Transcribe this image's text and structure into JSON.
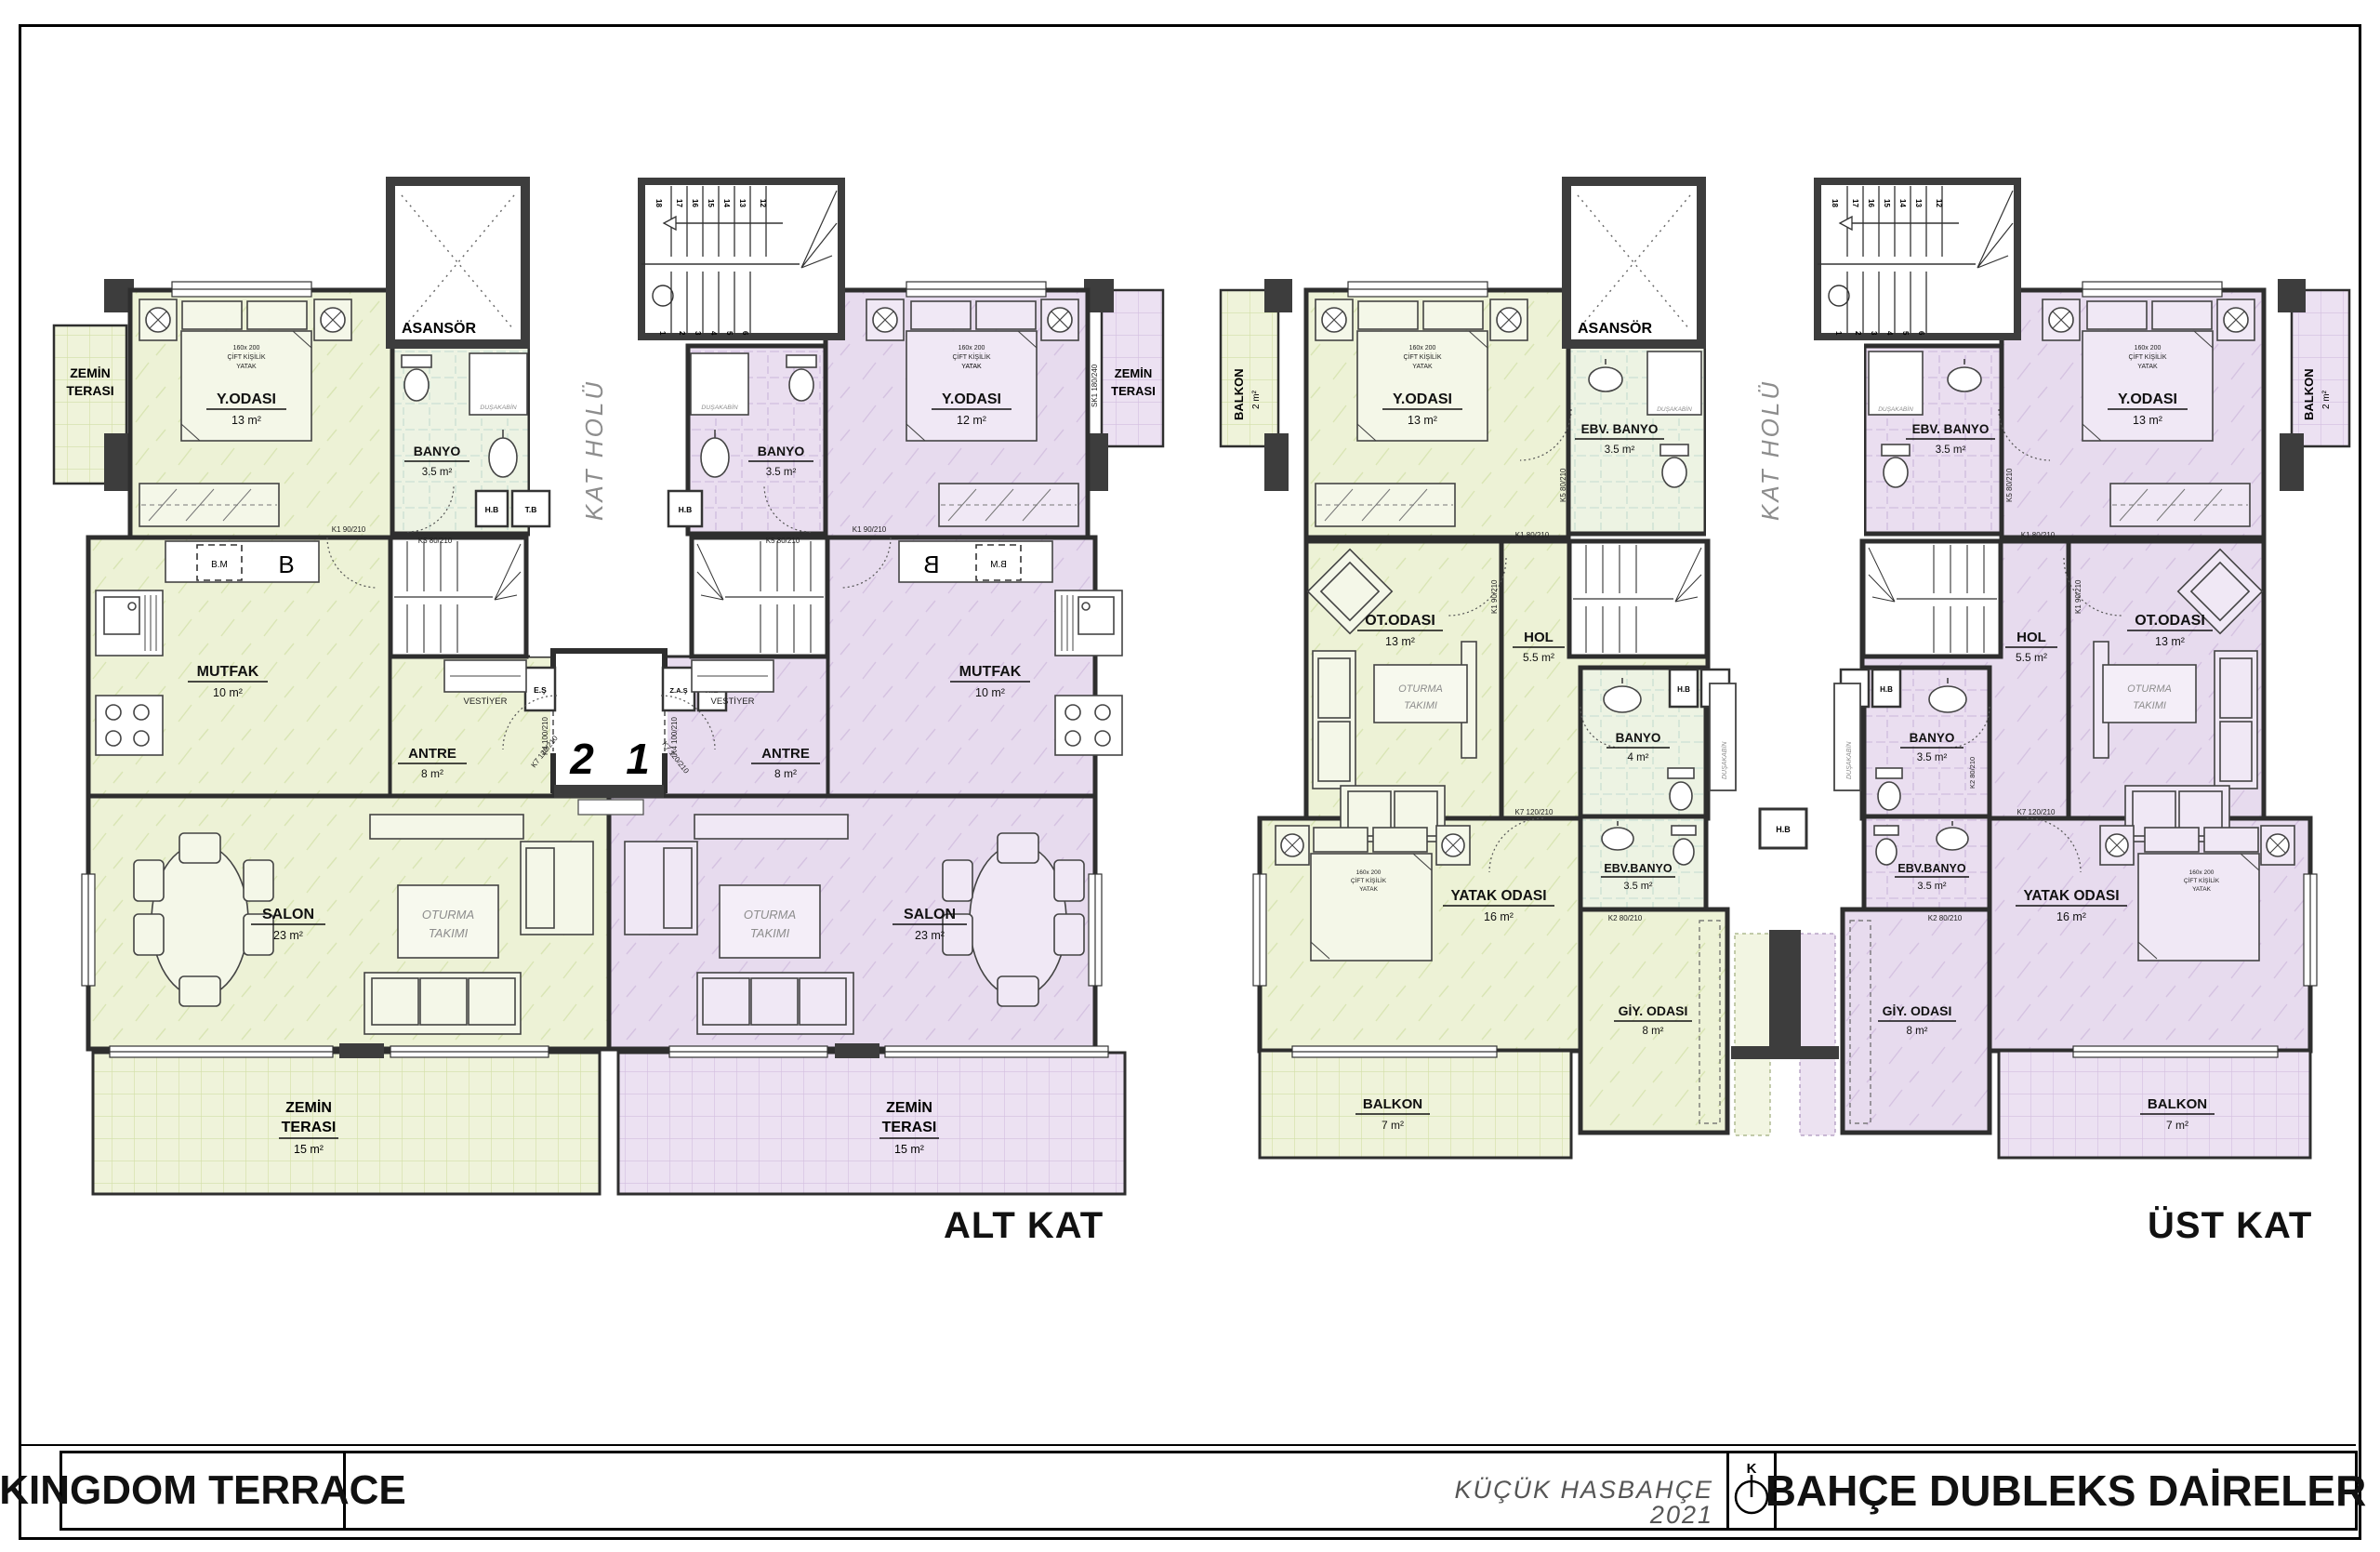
{
  "title_block": {
    "project": "KINGDOM TERRACE",
    "note1": "KÜÇÜK HASBAHÇE",
    "note2": "2021",
    "compass": "K",
    "sheet": "BAHÇE DUBLEKS DAİRELER"
  },
  "labels": {
    "alt_kat": "ALT KAT",
    "ust_kat": "ÜST KAT"
  },
  "common": {
    "asansor": "ASANSÖR",
    "kat_holu": "KAT HOLÜ",
    "dusakabin": "DUŞAKABİN",
    "vestiyer": "VESTİYER",
    "oturma": {
      "l1": "OTURMA",
      "l2": "TAKIMI"
    },
    "bed_note": {
      "l1": "160x 200",
      "l2": "ÇİFT KİŞİLİK",
      "l3": "YATAK"
    },
    "boxes": {
      "hb": "H.B",
      "tb": "T.B",
      "es": "E.Ş",
      "zas": "Z.A.Ş"
    },
    "doors": {
      "k1_90": "K1 90/210",
      "k1_80": "K1 80/210",
      "k2_80": "K2 80/210",
      "k4_100": "K4 100/210",
      "k5_80": "K5 80/210",
      "k7_120": "K7 120/210",
      "sk1": "SK1 180/240"
    },
    "stairs": {
      "s18": "18",
      "s17": "17",
      "s16": "16",
      "s15": "15",
      "s14": "14",
      "s13": "13",
      "s12": "12",
      "s1": "1",
      "s2": "2",
      "s3": "3",
      "s4": "4",
      "s5": "5",
      "s6": "6"
    }
  },
  "alt": {
    "unit2": {
      "number": "2",
      "terrace_top": {
        "l1": "ZEMİN",
        "l2": "TERASI"
      },
      "y_odasi": {
        "name": "Y.ODASI",
        "area": "13 m²"
      },
      "banyo": {
        "name": "BANYO",
        "area": "3.5 m²"
      },
      "mutfak": {
        "name": "MUTFAK",
        "area": "10 m²"
      },
      "antre": {
        "name": "ANTRE",
        "area": "8 m²"
      },
      "salon": {
        "name": "SALON",
        "area": "23 m²"
      },
      "terrace": {
        "l1": "ZEMİN",
        "l2": "TERASI",
        "area": "15 m²"
      },
      "bm": "B.M",
      "b": "B"
    },
    "unit1": {
      "number": "1",
      "terrace_top": {
        "l1": "ZEMİN",
        "l2": "TERASI"
      },
      "y_odasi": {
        "name": "Y.ODASI",
        "area": "12 m²"
      },
      "banyo": {
        "name": "BANYO",
        "area": "3.5 m²"
      },
      "mutfak": {
        "name": "MUTFAK",
        "area": "10 m²"
      },
      "antre": {
        "name": "ANTRE",
        "area": "8 m²"
      },
      "salon": {
        "name": "SALON",
        "area": "23 m²"
      },
      "terrace": {
        "l1": "ZEMİN",
        "l2": "TERASI",
        "area": "15 m²"
      },
      "bm": "B.M",
      "b": "B"
    }
  },
  "ust": {
    "left": {
      "balkon_top": {
        "name": "BALKON",
        "area": "2 m²"
      },
      "y_odasi": {
        "name": "Y.ODASI",
        "area": "13 m²"
      },
      "ebv_banyo_top": {
        "name": "EBV. BANYO",
        "area": "3.5 m²"
      },
      "ot_odasi": {
        "name": "OT.ODASI",
        "area": "13 m²"
      },
      "hol": {
        "name": "HOL",
        "area": "5.5 m²"
      },
      "banyo": {
        "name": "BANYO",
        "area": "4 m²"
      },
      "ebv_banyo": {
        "name": "EBV.BANYO",
        "area": "3.5 m²"
      },
      "yatak": {
        "name": "YATAK ODASI",
        "area": "16 m²"
      },
      "giy": {
        "name": "GİY. ODASI",
        "area": "8 m²"
      },
      "balkon": {
        "name": "BALKON",
        "area": "7 m²"
      }
    },
    "right": {
      "balkon_top": {
        "name": "BALKON",
        "area": "2 m²"
      },
      "y_odasi": {
        "name": "Y.ODASI",
        "area": "13 m²"
      },
      "ebv_banyo_top": {
        "name": "EBV. BANYO",
        "area": "3.5 m²"
      },
      "ot_odasi": {
        "name": "OT.ODASI",
        "area": "13 m²"
      },
      "hol": {
        "name": "HOL",
        "area": "5.5 m²"
      },
      "banyo": {
        "name": "BANYO",
        "area": "3.5 m²"
      },
      "ebv_banyo": {
        "name": "EBV.BANYO",
        "area": "3.5 m²"
      },
      "yatak": {
        "name": "YATAK ODASI",
        "area": "16 m²"
      },
      "giy": {
        "name": "GİY. ODASI",
        "area": "8 m²"
      },
      "balkon": {
        "name": "BALKON",
        "area": "7 m²"
      }
    }
  }
}
